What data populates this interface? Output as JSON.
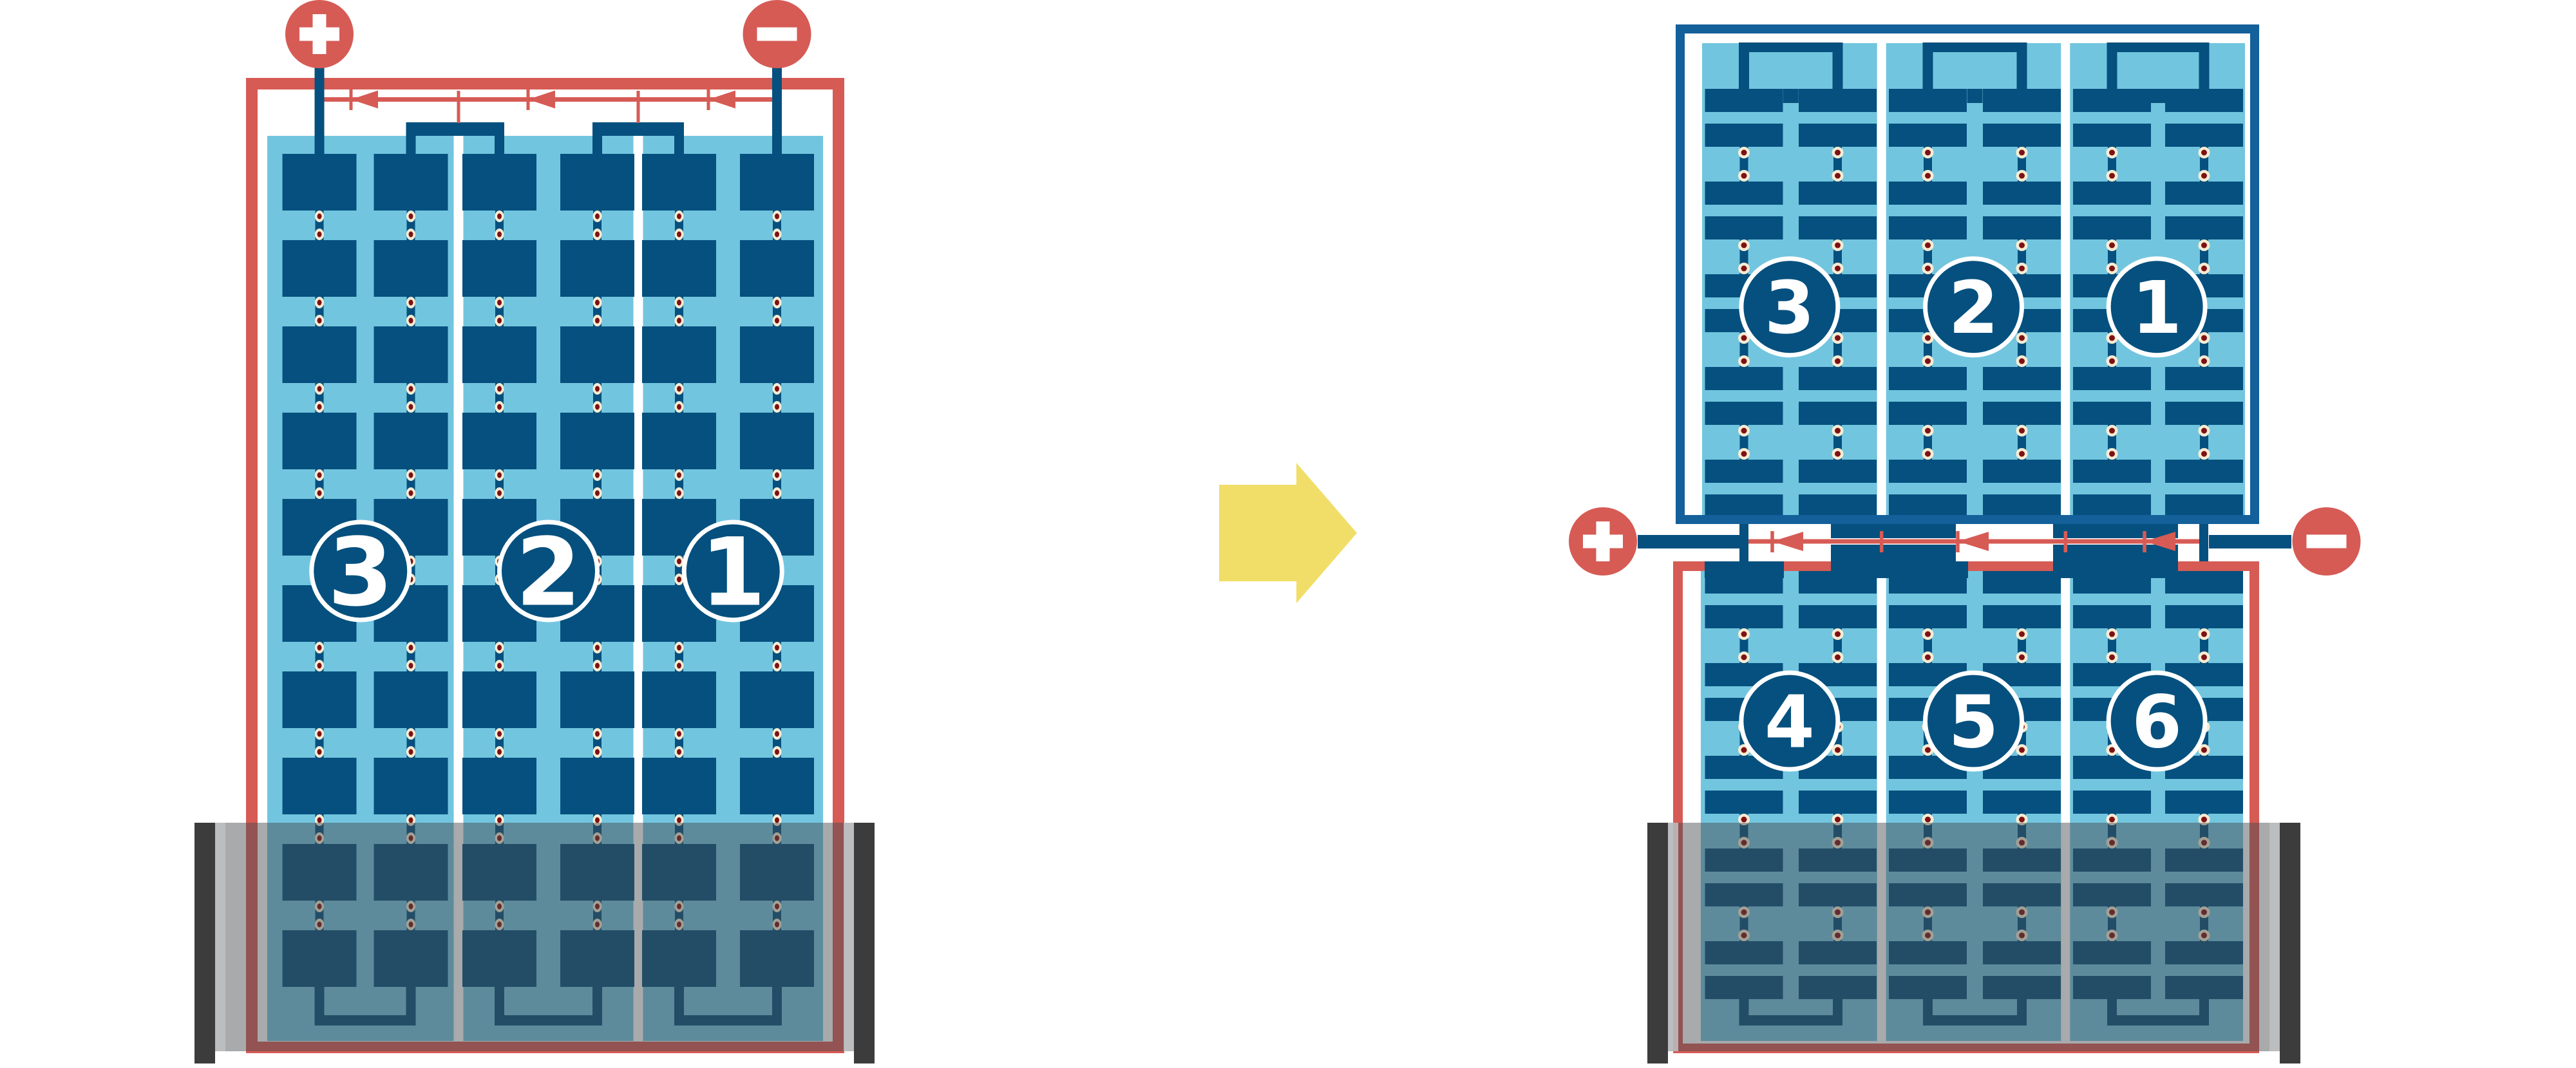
{
  "diagram": {
    "background": "#ffffff",
    "left_battery": {
      "cell_labels": [
        "3",
        "2",
        "1"
      ],
      "terminals": [
        {
          "sign": "+",
          "name": "positive",
          "position": "top-left"
        },
        {
          "sign": "−",
          "name": "negative",
          "position": "top-right"
        }
      ],
      "current_arrow_direction": "left"
    },
    "transform_arrow": {
      "direction": "right"
    },
    "right_battery": {
      "top_module_cell_labels": [
        "3",
        "2",
        "1"
      ],
      "bottom_module_cell_labels": [
        "4",
        "5",
        "6"
      ],
      "terminals": [
        {
          "sign": "+",
          "name": "positive",
          "position": "middle-left"
        },
        {
          "sign": "−",
          "name": "negative",
          "position": "middle-right"
        }
      ],
      "current_arrow_direction": "left"
    },
    "colors": {
      "red": "#D65B55",
      "plate_blue": "#05507E",
      "frame_blue": "#14609B",
      "light_blue": "#72C5DF",
      "cream": "#F6ECD3",
      "maroon": "#7D1113",
      "yellow": "#F1DE69",
      "tray_dark": "#3C3C3C",
      "tray_light": "#BFC1C2",
      "white": "#FFFFFF"
    }
  }
}
